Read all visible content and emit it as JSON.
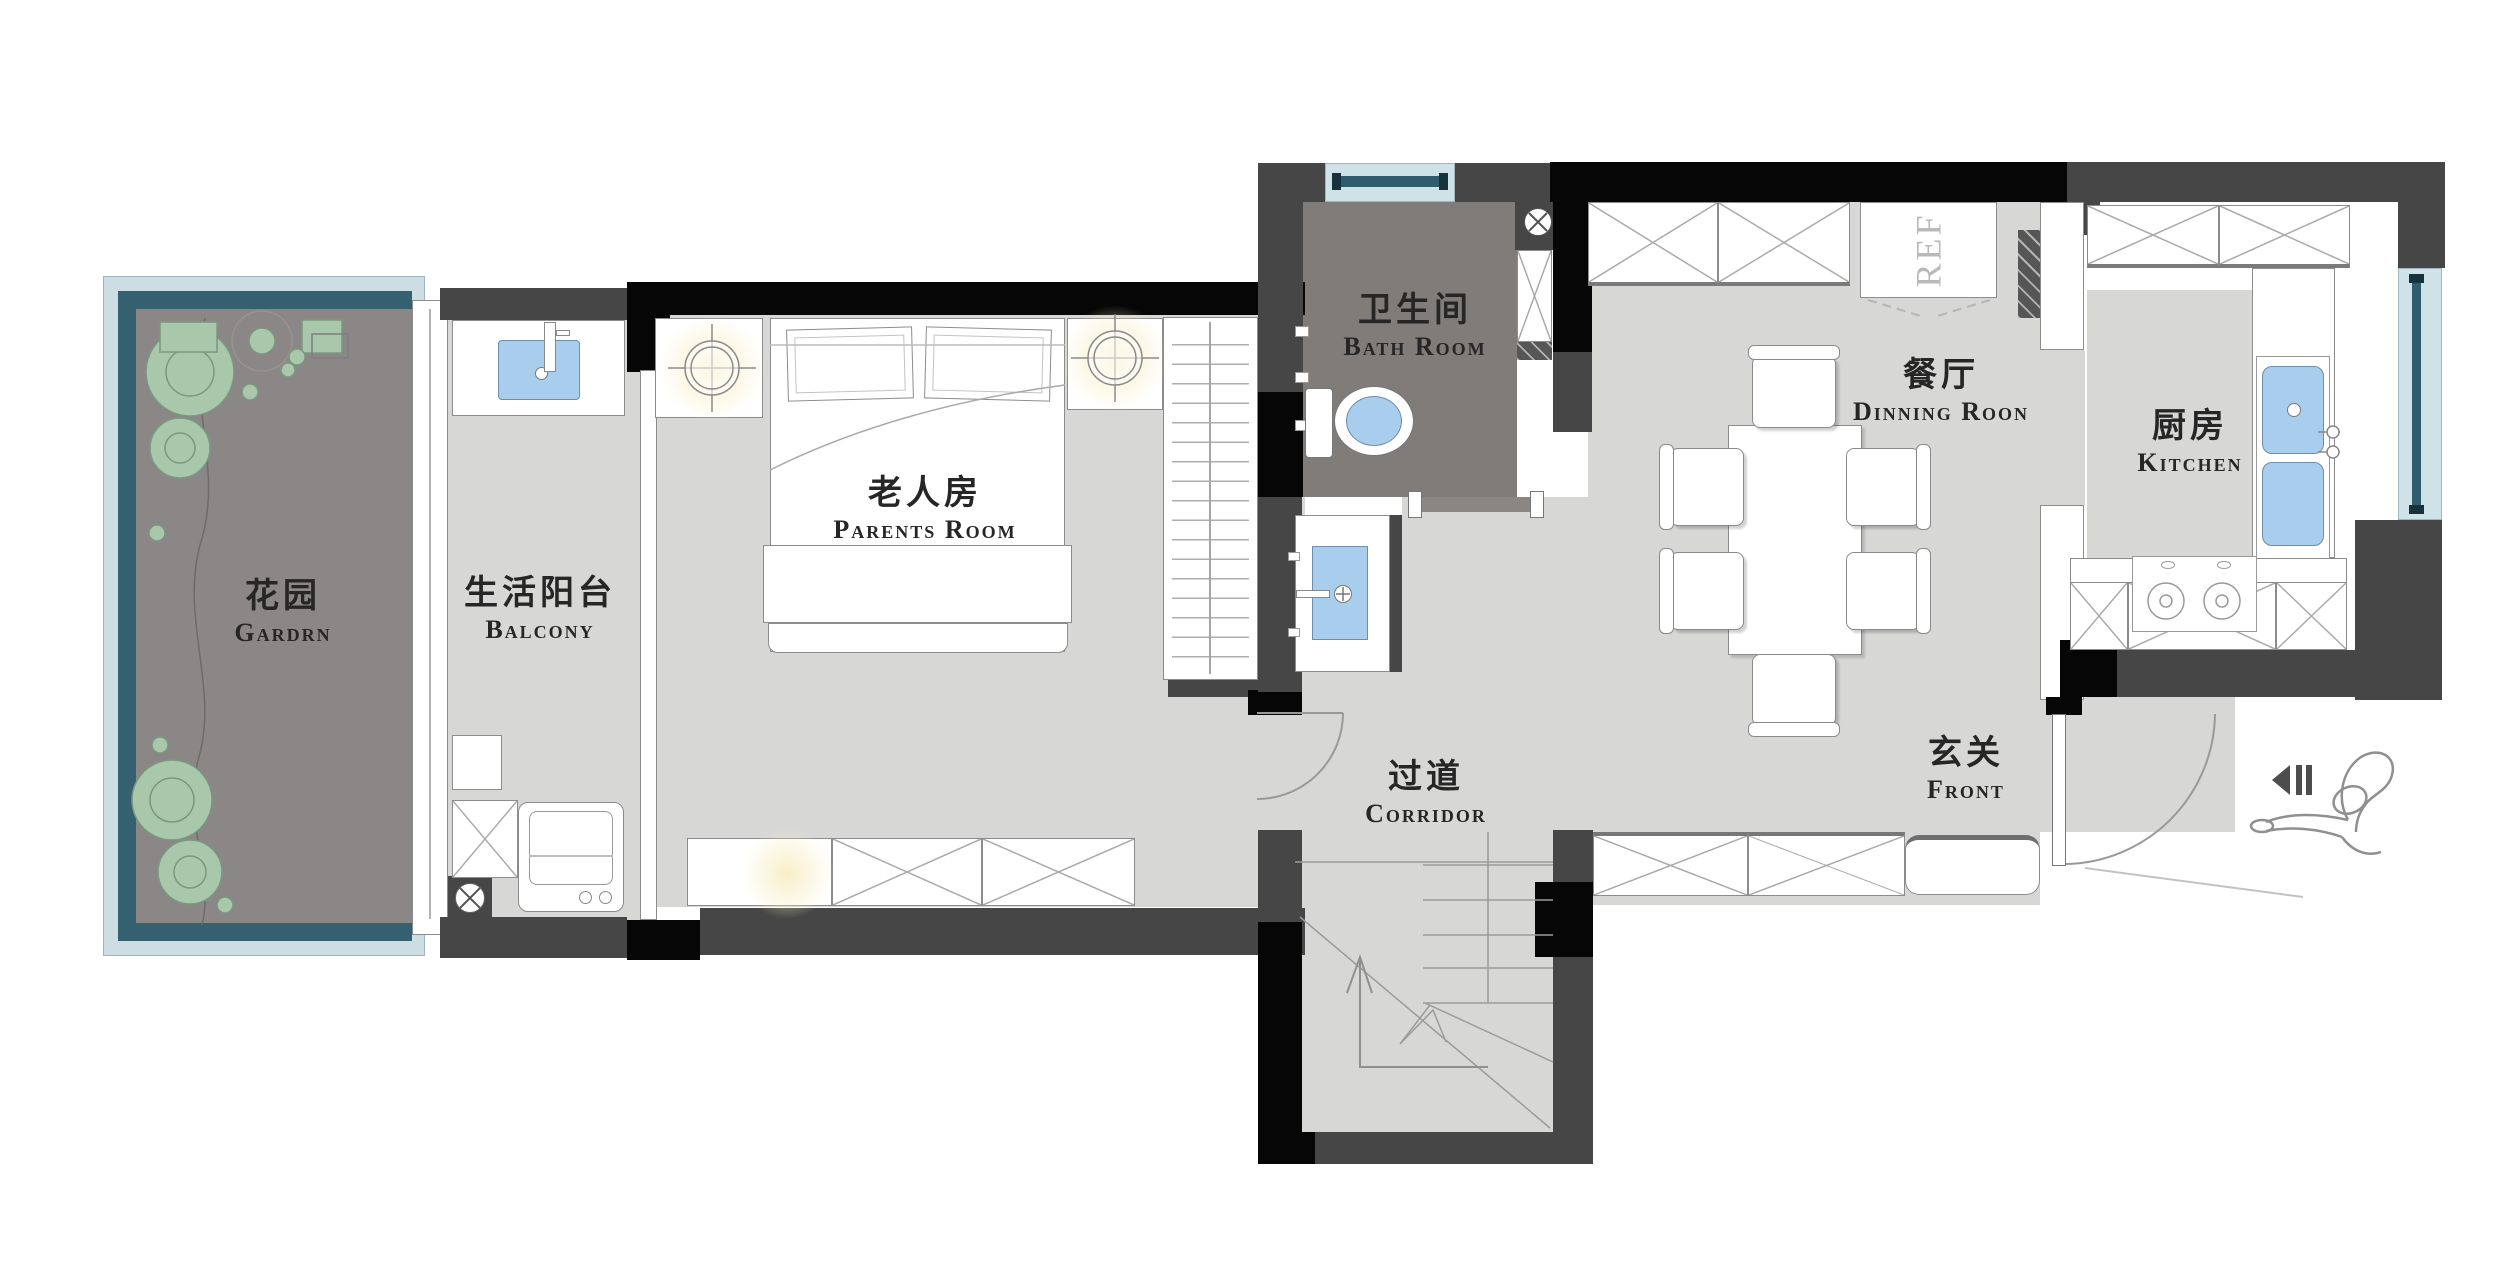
{
  "document": {
    "type": "residential floor plan"
  },
  "rooms": {
    "garden": {
      "zh": "花园",
      "en": "Gardrn"
    },
    "balcony": {
      "zh": "生活阳台",
      "en": "Balcony"
    },
    "parents_room": {
      "zh": "老人房",
      "en": "Parents Room"
    },
    "bathroom": {
      "zh": "卫生间",
      "en": "Bath Room"
    },
    "dining_room": {
      "zh": "餐厅",
      "en": "Dinning Roon"
    },
    "kitchen": {
      "zh": "厨房",
      "en": "Kitchen"
    },
    "corridor": {
      "zh": "过道",
      "en": "Corridor"
    },
    "entry": {
      "zh": "玄关",
      "en": "Front"
    }
  },
  "appliances": {
    "refrigerator_label": "REF"
  },
  "icons": [
    "floor-drain-icon",
    "entrance-arrow-icon",
    "person-icon",
    "ceiling-lamp-icon",
    "stair-up-arrow-icon"
  ],
  "colors": {
    "wall_black": "#060606",
    "wall_gray": "#464646",
    "floor_light": "#d7d7d6",
    "floor_dark_bath": "#7f7c7a",
    "floor_garden": "#8b8786",
    "window_glass": "#cfe2e8",
    "window_frame": "#2f5d6e",
    "fixture_blue": "#a9cdec",
    "plant_green": "#a9c7ab",
    "lamp_glow": "#f7eec4",
    "text": "#262626"
  }
}
